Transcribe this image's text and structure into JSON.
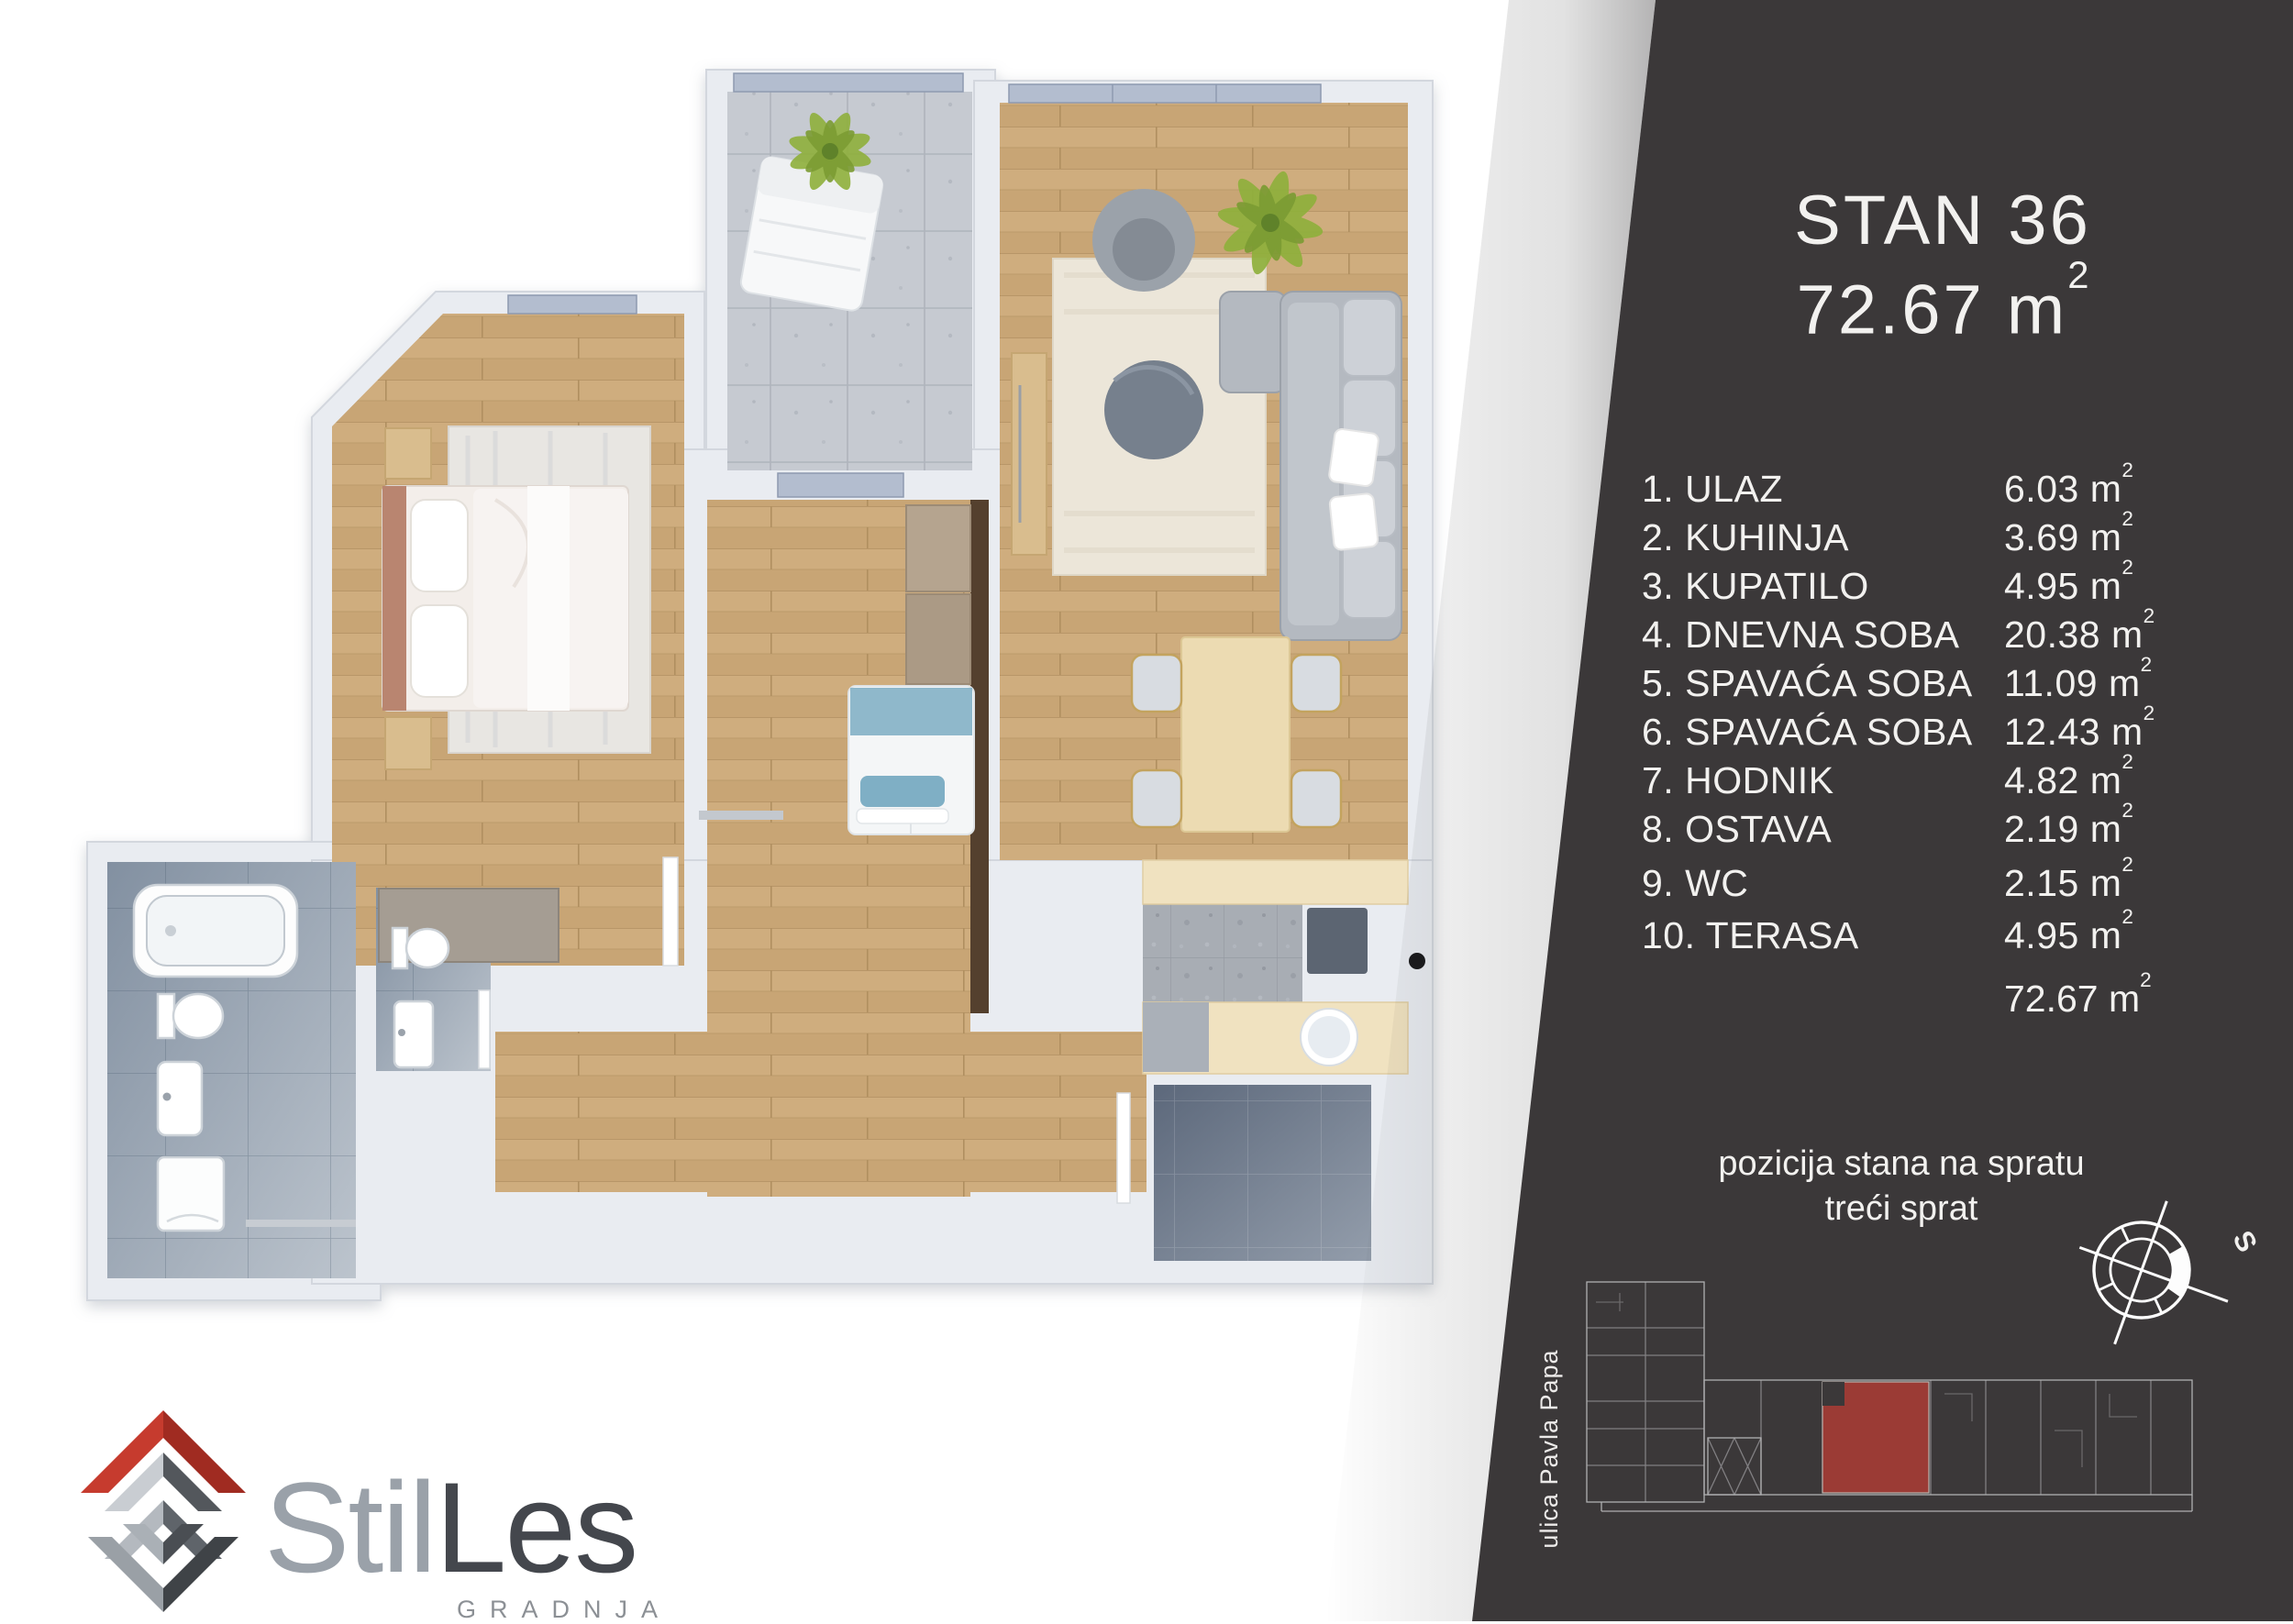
{
  "panel": {
    "bg_color": "#3b3839",
    "accent_red": "#a63c35",
    "title": "STAN 36",
    "size_value": "72.67",
    "unit": "m",
    "sup": "2",
    "rooms": [
      {
        "num": "1.",
        "name": "ULAZ",
        "area": "6.03"
      },
      {
        "num": "2.",
        "name": "KUHINJA",
        "area": "3.69"
      },
      {
        "num": "3.",
        "name": "KUPATILO",
        "area": "4.95"
      },
      {
        "num": "4.",
        "name": "DNEVNA SOBA",
        "area": "20.38"
      },
      {
        "num": "5.",
        "name": "SPAVAĆA SOBA",
        "area": "11.09"
      },
      {
        "num": "6.",
        "name": "SPAVAĆA SOBA",
        "area": "12.43"
      },
      {
        "num": "7.",
        "name": "HODNIK",
        "area": "4.82"
      },
      {
        "num": "8.",
        "name": "OSTAVA",
        "area": "2.19"
      },
      {
        "num": "9.",
        "name": "WC",
        "area": "2.15"
      },
      {
        "num": "10.",
        "name": "TERASA",
        "area": "4.95"
      }
    ],
    "total_area": "72.67",
    "position_line1": "pozicija stana na spratu",
    "position_line2": "treći sprat",
    "street_label": "ulica Pavla Papa",
    "compass_label": "S"
  },
  "logo": {
    "brand_part1": "Stil",
    "brand_part2": "Les",
    "subtitle": "GRADNJA",
    "roof_red": "#c63b2e"
  },
  "floor_plan": {
    "wall_color": "#e9ecf1",
    "wood_color": "#cfad7e",
    "tile_light": "#c6cad1",
    "tile_blue_dark": "#5c687b",
    "highlight_red": "#a63c35"
  }
}
